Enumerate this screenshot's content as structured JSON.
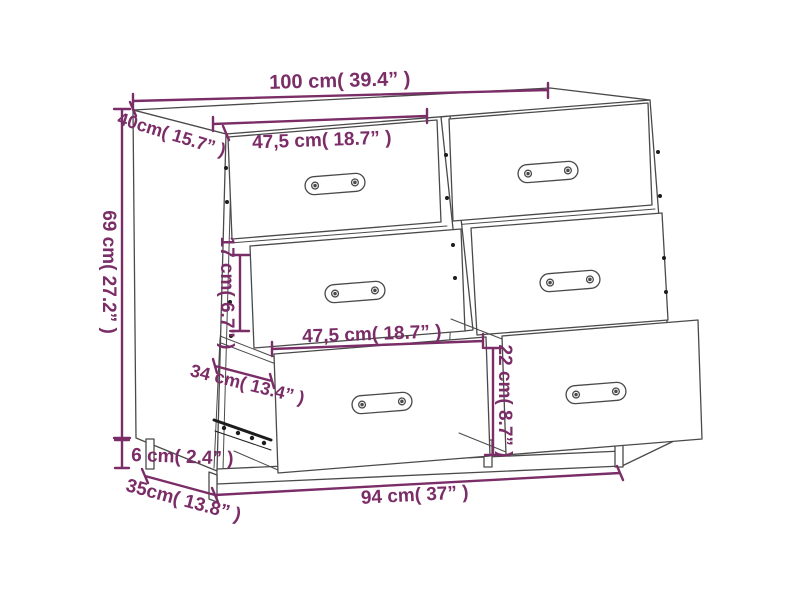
{
  "diagram": {
    "subject": "chest-of-drawers-with-6-drawers-two-bottom-drawers-open",
    "style": {
      "dimension_color": "#7b2d67",
      "outline_color": "#4a4a4a",
      "rail_color": "#1c1c1c",
      "background": "#ffffff"
    },
    "labels": {
      "width_top": "100 cm( 39.4” )",
      "depth_top": "40cm( 15.7” )",
      "height_side": "69 cm( 27.2” )",
      "drawer_width_upper": "47,5 cm( 18.7” )",
      "inner_gap_height": "17 cm( 6.7” )",
      "drawer_width_lower": "47,5 cm( 18.7” )",
      "open_drawer_depth": "34 cm( 13.4” )",
      "drawer_front_height": "22 cm( 8.7” )",
      "leg_height": "6 cm( 2.4” )",
      "depth_bottom": "35cm( 13.8” )",
      "width_bottom": "94 cm( 37” )"
    }
  }
}
